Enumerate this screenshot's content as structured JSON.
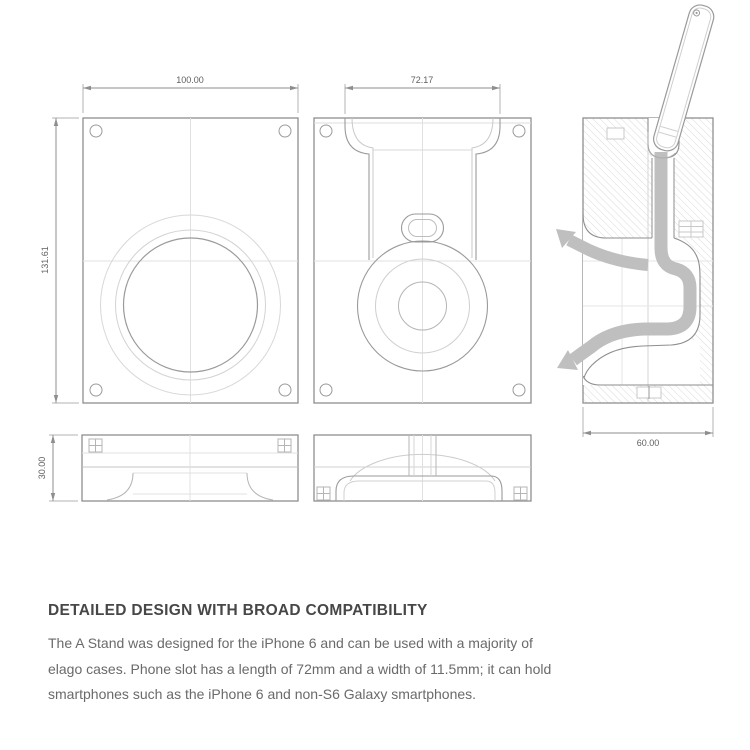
{
  "drawing": {
    "dimensions": {
      "front_width": "100.00",
      "front_height": "131.61",
      "slot_width": "72.17",
      "base_height": "30.00",
      "side_depth": "60.00"
    },
    "icons": {
      "cable_routing_arrows": "curved-arrow"
    },
    "colors": {
      "outline": "#8e8e8e",
      "light_line": "#d6d6d6",
      "hatch": "#dadada",
      "cable_gray": "#bfbfbf",
      "dim_text": "#5f5f5f"
    }
  },
  "description": {
    "heading": "DETAILED DESIGN WITH BROAD COMPATIBILITY",
    "body": "The A Stand was designed for the iPhone 6 and can be used with a majority of elago cases. Phone slot has a length of 72mm and a width of 11.5mm; it can hold smartphones such as the iPhone 6 and non-S6 Galaxy smartphones."
  }
}
